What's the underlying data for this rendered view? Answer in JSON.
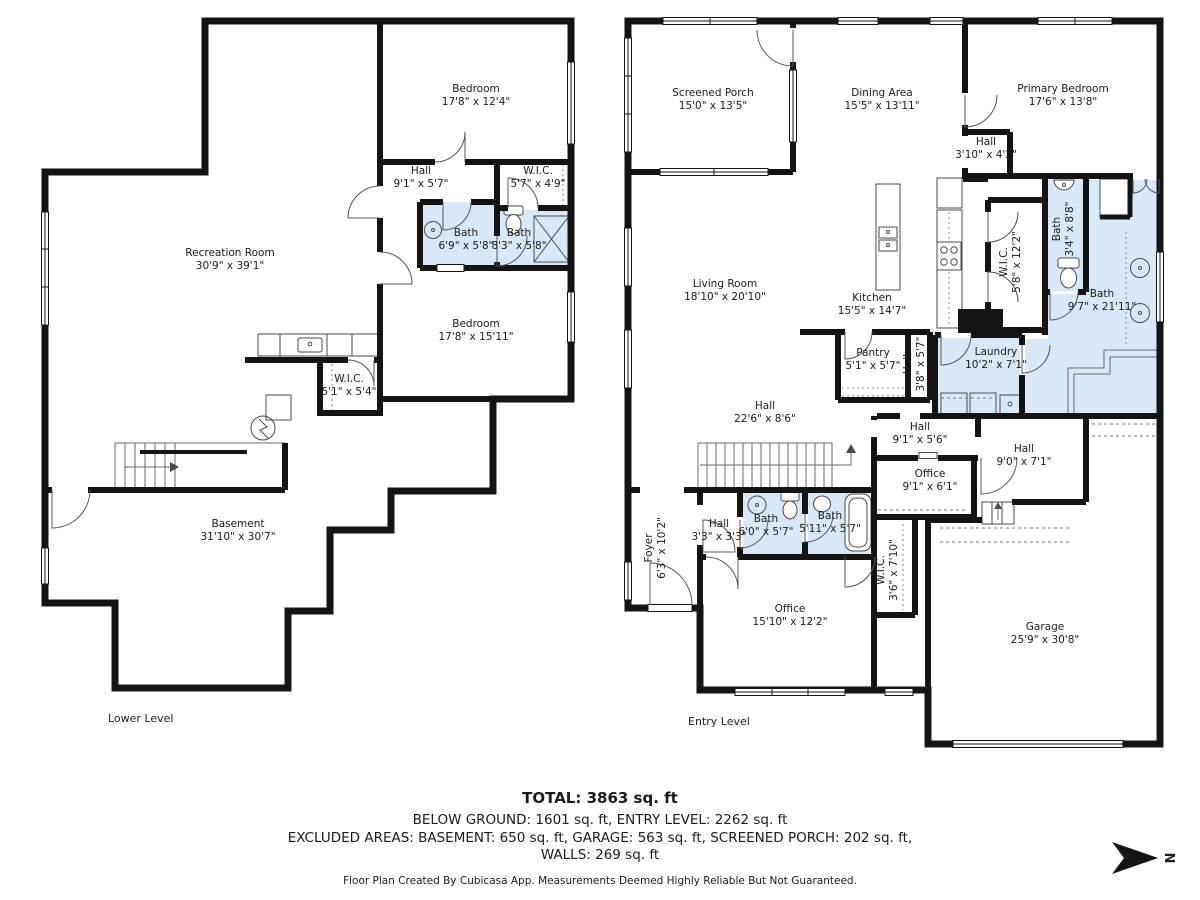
{
  "lower_level": {
    "caption": "Lower Level",
    "rooms": [
      {
        "name": "Bedroom",
        "dims": "17'8\" x 12'4\""
      },
      {
        "name": "Hall",
        "dims": "9'1\" x 5'7\""
      },
      {
        "name": "W.I.C.",
        "dims": "5'7\" x 4'9\""
      },
      {
        "name": "Bath",
        "dims": "6'9\" x 5'8\""
      },
      {
        "name": "Bath",
        "dims": "8'3\" x 5'8\""
      },
      {
        "name": "Recreation Room",
        "dims": "30'9\" x 39'1\""
      },
      {
        "name": "Bedroom",
        "dims": "17'8\" x 15'11\""
      },
      {
        "name": "W.I.C.",
        "dims": "5'1\" x 5'4\""
      },
      {
        "name": "Basement",
        "dims": "31'10\" x 30'7\""
      }
    ]
  },
  "entry_level": {
    "caption": "Entry Level",
    "rooms": [
      {
        "name": "Screened Porch",
        "dims": "15'0\" x 13'5\""
      },
      {
        "name": "Dining Area",
        "dims": "15'5\" x 13'11\""
      },
      {
        "name": "Primary Bedroom",
        "dims": "17'6\" x 13'8\""
      },
      {
        "name": "Hall",
        "dims": "3'10\" x 4'2\""
      },
      {
        "name": "Bath",
        "dims": "3'4\" x 8'8\""
      },
      {
        "name": "W.I.C.",
        "dims": "5'8\" x 12'2\""
      },
      {
        "name": "Bath",
        "dims": "9'7\" x 21'11\""
      },
      {
        "name": "Living Room",
        "dims": "18'10\" x 20'10\""
      },
      {
        "name": "Kitchen",
        "dims": "15'5\" x 14'7\""
      },
      {
        "name": "Pantry",
        "dims": "5'1\" x 5'7\""
      },
      {
        "name": "Hall",
        "dims": "3'8\" x 5'7\""
      },
      {
        "name": "Laundry",
        "dims": "10'2\" x 7'1\""
      },
      {
        "name": "Hall",
        "dims": "22'6\" x 8'6\""
      },
      {
        "name": "Hall",
        "dims": "9'1\" x 5'6\""
      },
      {
        "name": "Hall",
        "dims": "9'0\" x 7'1\""
      },
      {
        "name": "Office",
        "dims": "9'1\" x 6'1\""
      },
      {
        "name": "Foyer",
        "dims": "6'3\" x 10'2\""
      },
      {
        "name": "Hall",
        "dims": "3'3\" x 3'3\""
      },
      {
        "name": "Bath",
        "dims": "6'0\" x 5'7\""
      },
      {
        "name": "Bath",
        "dims": "5'11\" x 5'7\""
      },
      {
        "name": "Office",
        "dims": "15'10\" x 12'2\""
      },
      {
        "name": "W.I.C.",
        "dims": "3'6\" x 7'10\""
      },
      {
        "name": "Garage",
        "dims": "25'9\" x 30'8\""
      }
    ]
  },
  "summary": {
    "total": "TOTAL: 3863 sq. ft",
    "line2": "BELOW GROUND: 1601 sq. ft, ENTRY LEVEL: 2262 sq. ft",
    "line3": "EXCLUDED AREAS: BASEMENT: 650 sq. ft, GARAGE: 563 sq. ft, SCREENED PORCH: 202 sq. ft,",
    "line4": "WALLS: 269 sq. ft",
    "disclaimer": "Floor Plan Created By Cubicasa App. Measurements Deemed Highly Reliable But Not Guaranteed."
  },
  "compass": {
    "label": "N"
  },
  "colors": {
    "wall": "#141414",
    "bath_fill": "#d9e8f6"
  }
}
